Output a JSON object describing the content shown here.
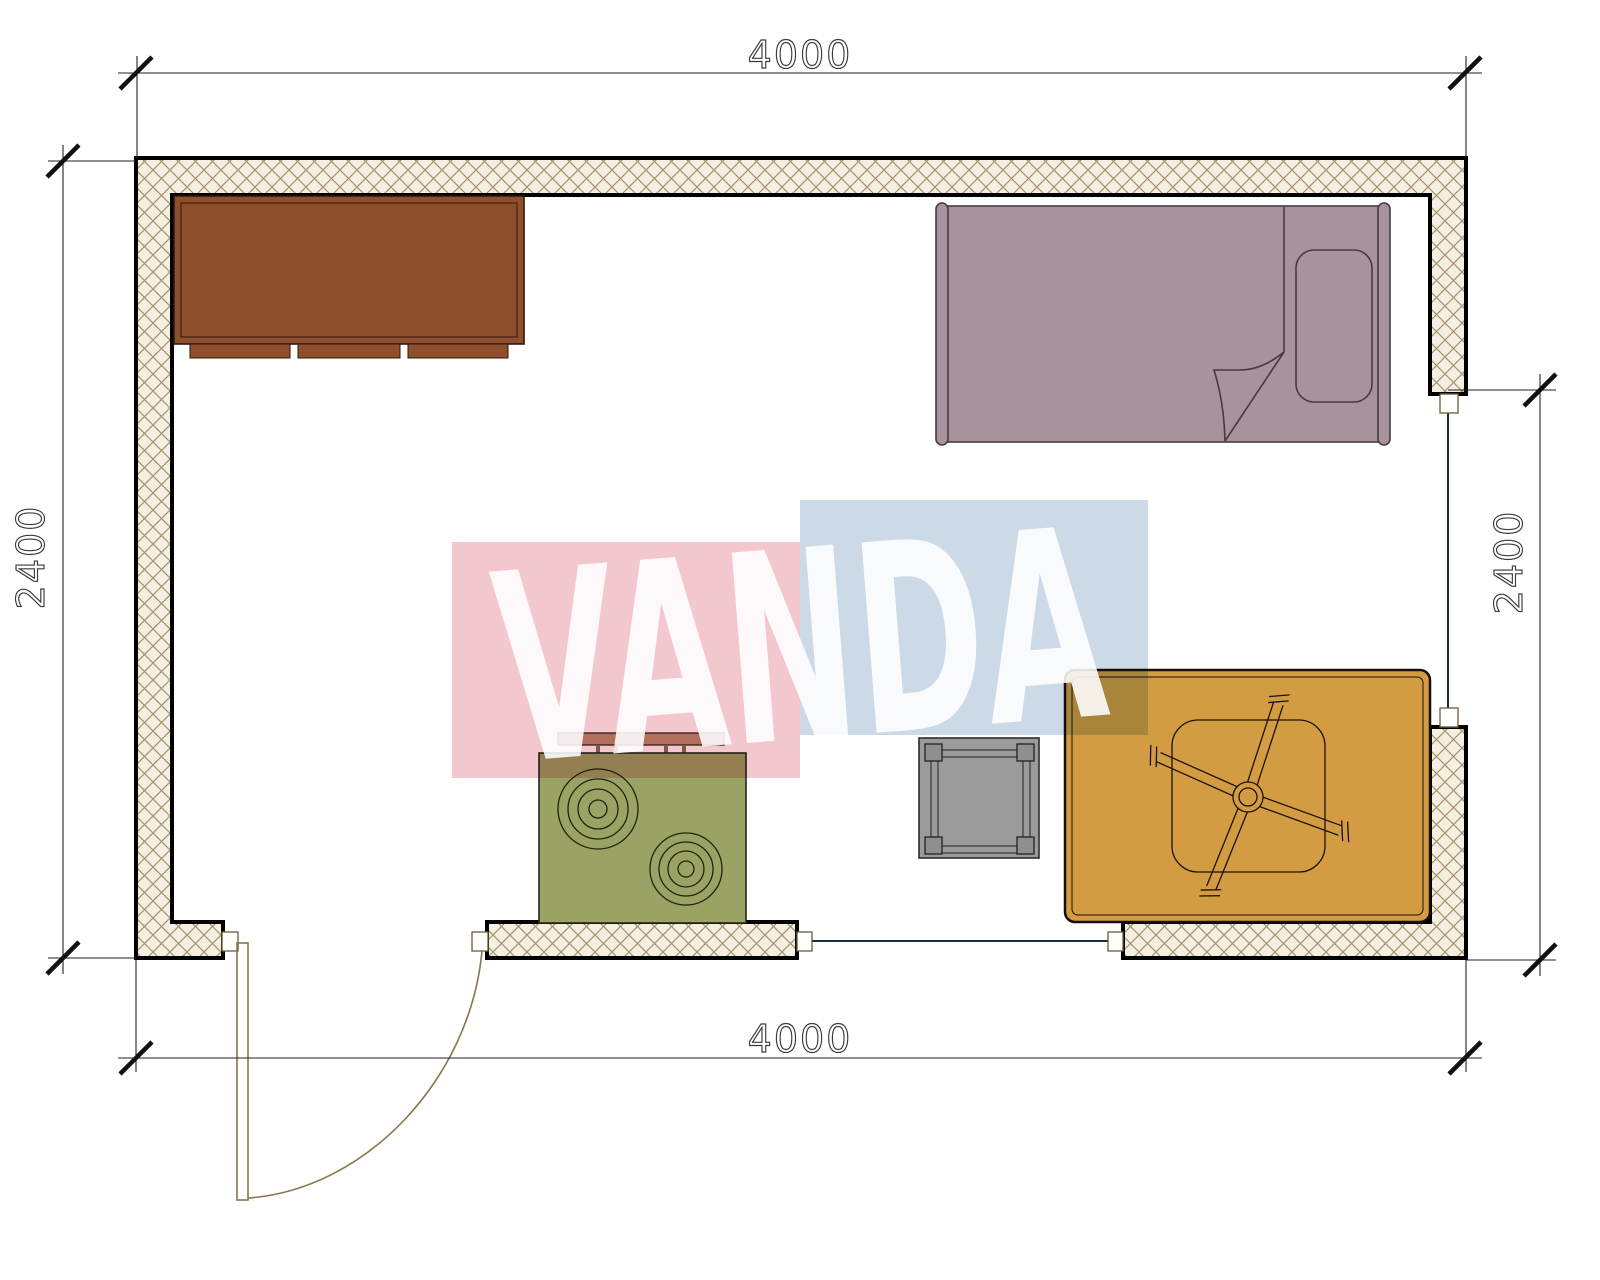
{
  "plan": {
    "type": "room floor plan",
    "dimensions": {
      "top": "4000",
      "bottom": "4000",
      "left": "2400",
      "right": "2400"
    },
    "watermark": {
      "text": "VANDA",
      "pink_color": "#f3c7ce",
      "blue_color": "#ccd9e7"
    },
    "colors": {
      "wall_fill": "#f4efe1",
      "hatch_line": "#a2946e",
      "wall_outline": "#000000",
      "cabinet": "#8f4f2d",
      "bed": "#a8929e",
      "stove": "#9aa364",
      "stove_shelf": "#bc8e71",
      "side_table": "#9b9b9b",
      "rug": "#d39c42"
    },
    "furniture": {
      "cabinet": "cabinet",
      "bed": "single bed with pillow and folded blanket",
      "stove": "two-burner stove with back shelf",
      "side_table": "square side table",
      "rug": "rug with ceiling fan symbol",
      "door": "door with swing arc",
      "window_bottom": "window",
      "window_right": "window"
    }
  }
}
